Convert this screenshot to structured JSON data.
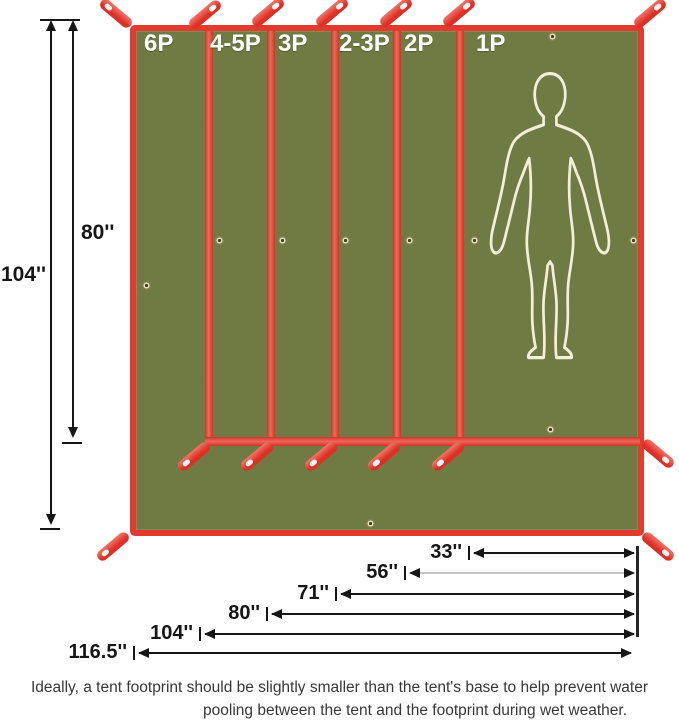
{
  "diagram": {
    "title": "Tent footprint size comparison diagram",
    "panel_labels": [
      "6P",
      "4-5P",
      "3P",
      "2-3P",
      "2P",
      "1P"
    ],
    "height_dims": {
      "full": "104''",
      "inner": "80''"
    },
    "width_dims": [
      "33''",
      "56''",
      "71''",
      "80''",
      "104''",
      "116.5''"
    ],
    "sizes": [
      {
        "label": "6P",
        "width": "116.5''",
        "height": "104''"
      },
      {
        "label": "4-5P",
        "width": "104''",
        "height": "80''"
      },
      {
        "label": "3P",
        "width": "80''",
        "height": "80''"
      },
      {
        "label": "2-3P",
        "width": "71''",
        "height": "80''"
      },
      {
        "label": "2P",
        "width": "56''",
        "height": "80''"
      },
      {
        "label": "1P",
        "width": "33''",
        "height": "80''"
      }
    ],
    "caption": {
      "line1": "Ideally, a tent footprint should be slightly smaller than the tent's base to help prevent water",
      "line2": "pooling between the tent and the footprint during wet weather."
    },
    "colors": {
      "tarp_green": "#6f7b43",
      "trim_red": "#e5392c",
      "silhouette_cream": "#f2efdb",
      "dimension_black": "#1a1a1a"
    }
  }
}
